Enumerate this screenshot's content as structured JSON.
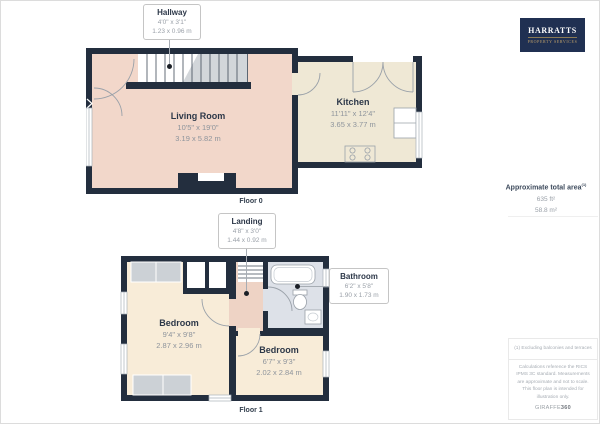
{
  "floor0": {
    "label": "Floor 0",
    "rooms": [
      {
        "name": "Hallway",
        "imperial": "4'0\" x 3'1\"",
        "metric": "1.23 x 0.96 m"
      },
      {
        "name": "Living Room",
        "imperial": "10'5\" x 19'0\"",
        "metric": "3.19 x 5.82 m"
      },
      {
        "name": "Kitchen",
        "imperial": "11'11\" x 12'4\"",
        "metric": "3.65 x 3.77 m"
      }
    ]
  },
  "floor1": {
    "label": "Floor 1",
    "rooms": [
      {
        "name": "Landing",
        "imperial": "4'8\" x 3'0\"",
        "metric": "1.44 x 0.92 m"
      },
      {
        "name": "Bathroom",
        "imperial": "6'2\" x 5'8\"",
        "metric": "1.90 x 1.73 m"
      },
      {
        "name": "Bedroom",
        "imperial": "9'4\" x 9'8\"",
        "metric": "2.87 x 2.96 m"
      },
      {
        "name": "Bedroom",
        "imperial": "6'7\" x 9'3\"",
        "metric": "2.02 x 2.84 m"
      }
    ]
  },
  "sidebar": {
    "logo": {
      "brand": "HARRATTS",
      "tagline": "PROPERTY SERVICES"
    },
    "area": {
      "label": "Approximate total area",
      "footnote_ref": "(1)",
      "imperial": "635 ft²",
      "metric": "58.8 m²"
    },
    "footnote": "(1) Excluding balconies and terraces",
    "disclaimer": "Calculations reference the RICS IPMS 3C standard. Measurements are approximate and not to scale. This floor plan is intended for illustration only.",
    "credit": {
      "brand": "GIRAFFE",
      "suffix": "360"
    }
  },
  "colors": {
    "wall": "#232e3e",
    "living_room": "#f2d7ca",
    "kitchen": "#efe8d5",
    "bedroom": "#f8ecd8",
    "bathroom": "#dde1e8",
    "landing": "#eed3c5",
    "stairs": "#d2d6da",
    "wardrobe": "#ccd1d6",
    "logo_bg": "#203052",
    "logo_gold": "#bfa06a"
  }
}
